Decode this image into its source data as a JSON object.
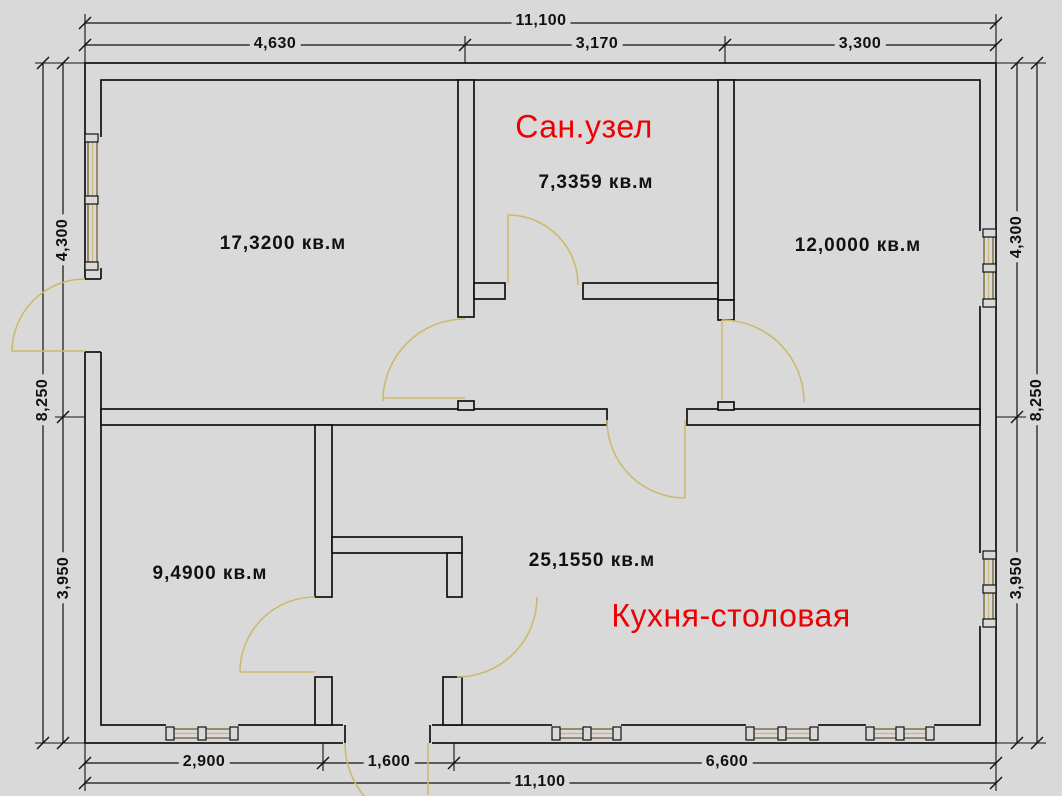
{
  "dimensions": {
    "top": {
      "total": "11,100",
      "segments": [
        "4,630",
        "3,170",
        "3,300"
      ]
    },
    "bottom": {
      "total": "11,100",
      "segments": [
        "2,900",
        "1,600",
        "6,600"
      ]
    },
    "left": {
      "total": "8,250",
      "segments": [
        "4,300",
        "3,950"
      ]
    },
    "right": {
      "total": "8,250",
      "segments": [
        "4,300",
        "3,950"
      ]
    }
  },
  "rooms": {
    "bathroom": {
      "label": "Сан.узел",
      "area": "7,3359 кв.м"
    },
    "room_top_left": {
      "area": "17,3200 кв.м"
    },
    "room_top_right": {
      "area": "12,0000 кв.м"
    },
    "room_bottom_left": {
      "area": "9,4900 кв.м"
    },
    "kitchen": {
      "label": "Кухня-столовая",
      "area": "25,1550 кв.м"
    }
  },
  "colors": {
    "background": "#d9d9d9",
    "line": "#111111",
    "door_window_accent": "#cdb96e",
    "window_frame": "#6b5525",
    "room_label_red": "#ee0000"
  }
}
